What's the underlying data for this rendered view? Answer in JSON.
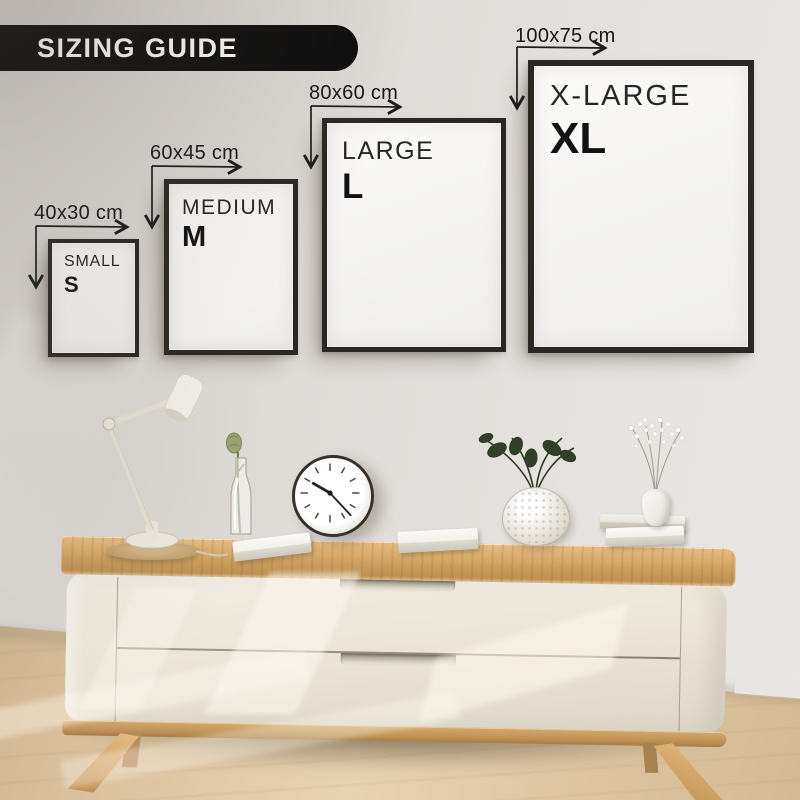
{
  "banner": {
    "title": "SIZING GUIDE"
  },
  "sizes": [
    {
      "name": "SMALL",
      "abbr": "S",
      "dimensions": "40x30 cm"
    },
    {
      "name": "MEDIUM",
      "abbr": "M",
      "dimensions": "60x45 cm"
    },
    {
      "name": "LARGE",
      "abbr": "L",
      "dimensions": "80x60 cm"
    },
    {
      "name": "X-LARGE",
      "abbr": "XL",
      "dimensions": "100x75 cm"
    }
  ],
  "colors": {
    "banner_bg": "#0d0d0d",
    "banner_text": "#ffffff",
    "wall": "#dedad6",
    "frame_border": "#2b2723",
    "frame_mat": "#f5f4f2",
    "label_text": "#171717",
    "wood_top": "#d5a768",
    "cabinet_body": "#eae3d6",
    "floor": "#dcc5a0"
  },
  "scene_icons": [
    "desk-lamp-icon",
    "glass-bottle-vase-icon",
    "wall-clock-icon",
    "book-icon",
    "bubble-vase-icon",
    "book-stack-icon",
    "dried-flowers-vase-icon",
    "sideboard-icon"
  ]
}
